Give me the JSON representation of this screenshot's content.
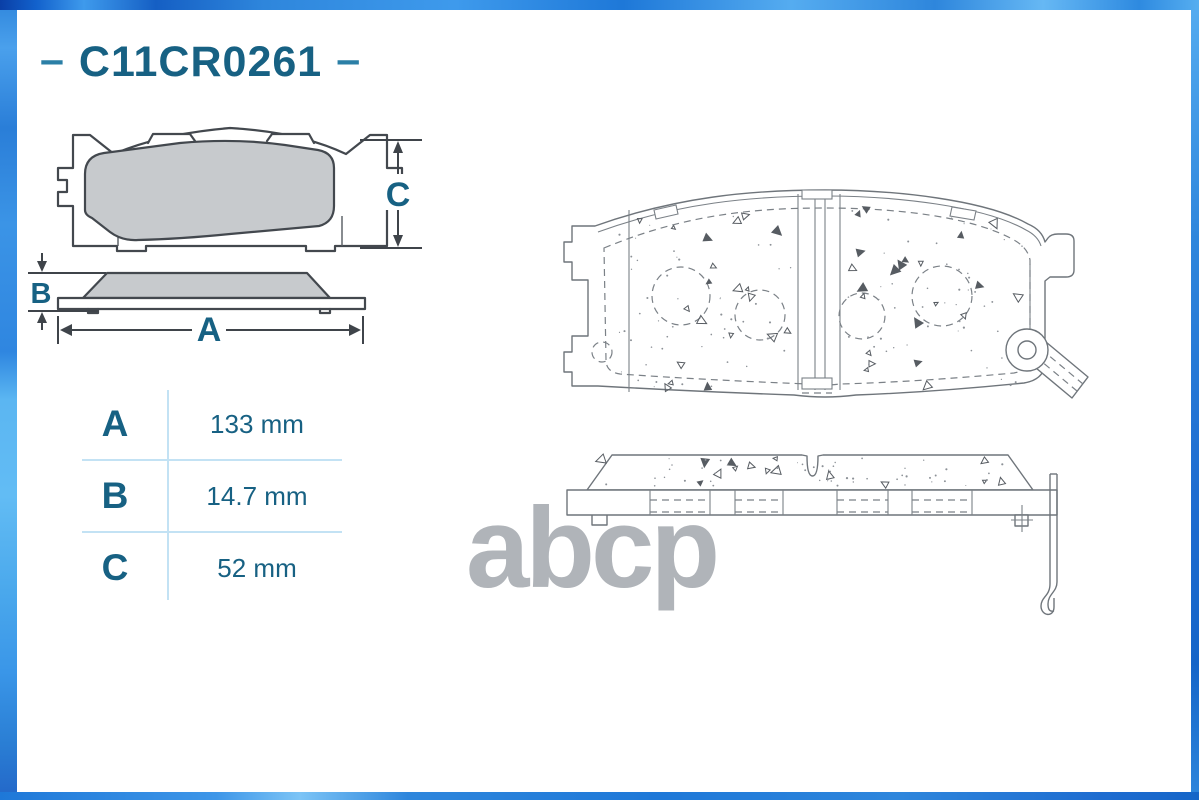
{
  "header": {
    "dash_left": "–",
    "part_number": "C11CR0261",
    "dash_right": "–"
  },
  "drawings": {
    "front_view": {
      "dim_label": "C"
    },
    "side_view": {
      "dim_width_label": "A",
      "dim_thickness_label": "B"
    }
  },
  "table": {
    "rows": [
      {
        "label": "A",
        "value": "133 mm"
      },
      {
        "label": "B",
        "value": "14.7 mm"
      },
      {
        "label": "C",
        "value": "52 mm"
      }
    ]
  },
  "watermark": "abcp",
  "colors": {
    "accent_text": "#176183",
    "dash_accent": "#2b7fa6",
    "table_line": "#c3e2f4",
    "watermark_gray": "#b0b4b9",
    "small_drawing_line": "#43484e",
    "large_drawing_line": "#6f757b",
    "pad_fill": "#c7cacd",
    "frame_blue": "#2e86dc"
  }
}
